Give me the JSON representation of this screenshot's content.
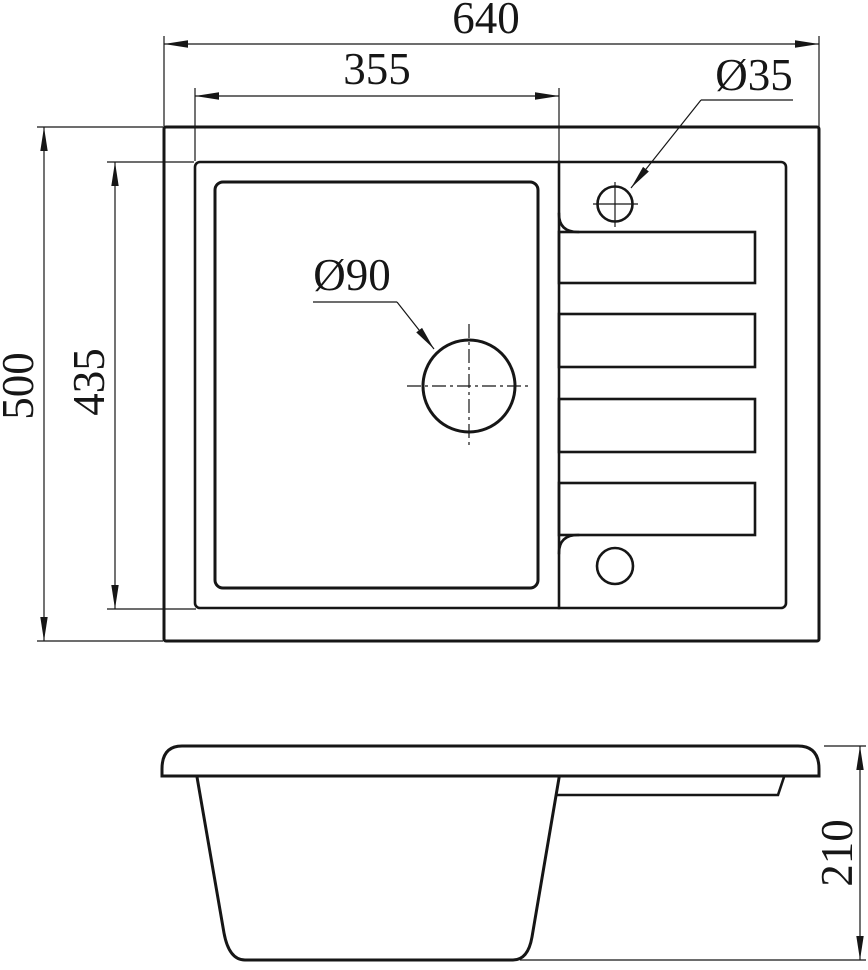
{
  "meta": {
    "type": "technical-drawing",
    "subject": "kitchen sink with drainboard - dimensioned top and side views",
    "units_implied": "mm"
  },
  "colors": {
    "line": "#161616",
    "background": "#ffffff"
  },
  "top_view": {
    "dim_overall_width": "640",
    "dim_bowl_area_width": "355",
    "dim_overall_depth": "500",
    "dim_inner_depth": "435",
    "label_faucet_hole_diameter": "Ø35",
    "label_drain_hole_diameter": "Ø90"
  },
  "side_view": {
    "dim_overall_height": "210"
  }
}
